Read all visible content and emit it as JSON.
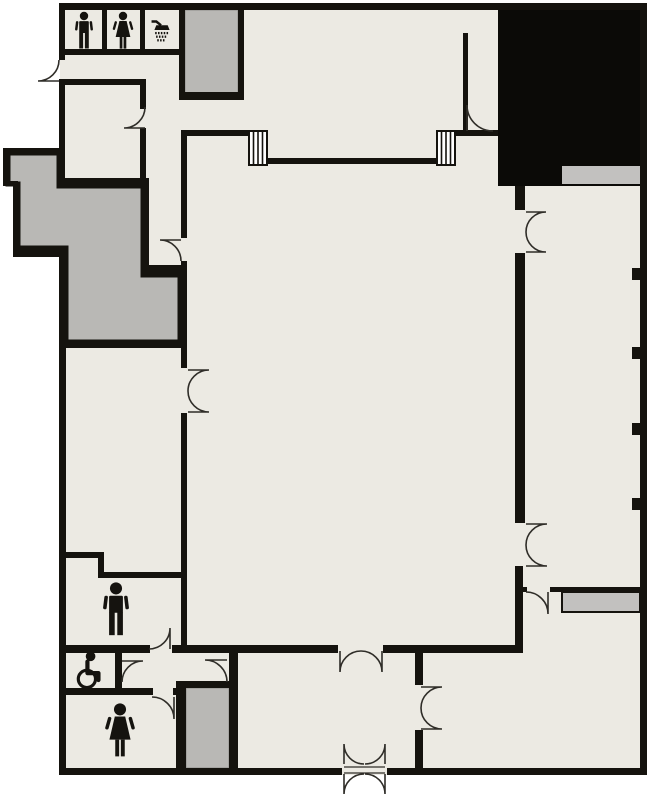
{
  "document": {
    "kind": "building-floor-plan"
  },
  "colors": {
    "outside": "#FFFFFF",
    "floor": "#ECEAE3",
    "wall": "#15130E",
    "void": "#0B0A07",
    "service": "#B9B8B5",
    "service_light": "#C2C1BF",
    "service_edge": "#8F8E8B",
    "door": "#2F2D28",
    "icon": "#15130F"
  },
  "icons": [
    {
      "name": "man-icon",
      "meaning": "men's room (small, top row)"
    },
    {
      "name": "woman-icon",
      "meaning": "women's room (small, top row)"
    },
    {
      "name": "shower-icon",
      "meaning": "shower room"
    },
    {
      "name": "wheelchair-icon",
      "meaning": "accessible room"
    },
    {
      "name": "man-icon-large",
      "meaning": "men's restroom (bottom left)"
    },
    {
      "name": "woman-icon-large",
      "meaning": "women's restroom (bottom left)"
    }
  ]
}
